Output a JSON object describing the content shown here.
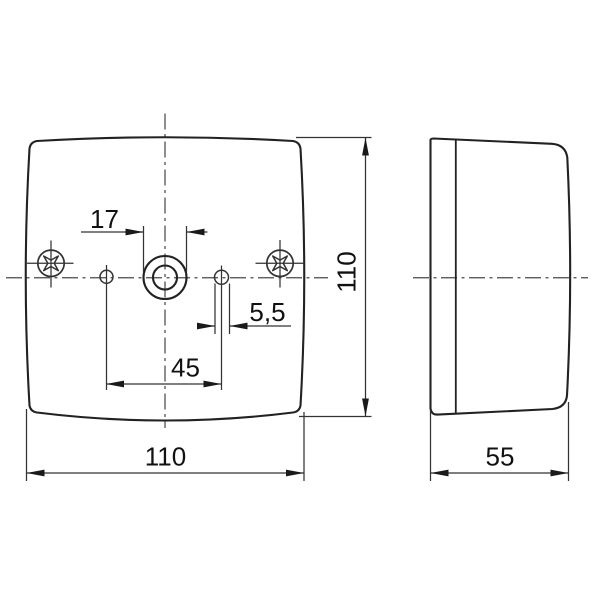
{
  "drawing": {
    "background_color": "#ffffff",
    "outline_color": "#222222",
    "dimension_color": "#333333",
    "centerline_color": "#4a4a4a",
    "text_color": "#111111",
    "front_view": {
      "dim_center_boss": "17",
      "dim_small_hole": "5,5",
      "dim_hole_spacing": "45",
      "dim_width": "110",
      "dim_height": "110"
    },
    "side_view": {
      "dim_depth": "55"
    }
  }
}
